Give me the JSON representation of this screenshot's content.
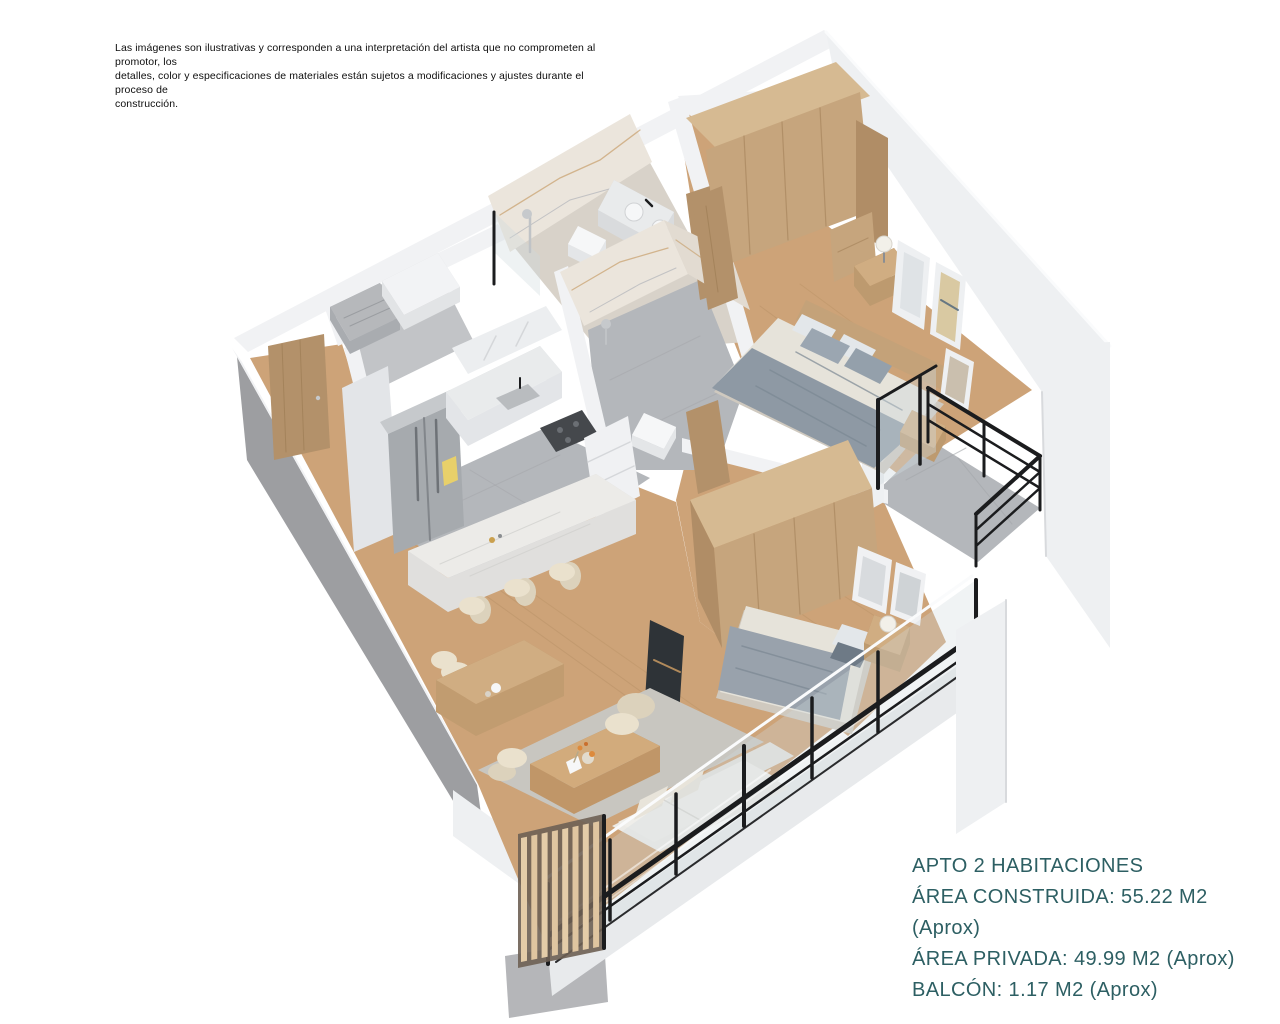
{
  "disclaimer": {
    "line1": "Las imágenes son ilustrativas y corresponden a una interpretación del artista que no comprometen al promotor, los",
    "line2": "detalles, color y especificaciones de materiales están sujetos a modificaciones y ajustes durante el proceso de",
    "line3": "construcción."
  },
  "specs": {
    "title": "APTO 2 HABITACIONES",
    "area_construida": "ÁREA CONSTRUIDA: 55.22 M2 (Aprox)",
    "area_privada": "ÁREA PRIVADA: 49.99 M2 (Aprox)",
    "balcon": "BALCÓN: 1.17 M2 (Aprox)"
  },
  "palette": {
    "background": "#ffffff",
    "wallTop": "#f1f2f4",
    "wallWhite": "#eef0f2",
    "wallBright": "#fafbfc",
    "faceGray": "#9d9ea1",
    "slabGray": "#b5b6b9",
    "wood": "#cda378",
    "woodLine": "#b08a5e",
    "tile": "#b4b7bb",
    "tileLine": "#a3a6aa",
    "bathFloor": "#d8d2c9",
    "marble": "#ebe5dc",
    "marbleVein": "#c49a62",
    "marbleGray": "#9aa0ac",
    "wardrobe": "#c6a57d",
    "wardrobeTop": "#d6ba92",
    "wardrobeSide": "#b08d66",
    "doorWood": "#b3916a",
    "steel": "#a6aaae",
    "steelDark": "#82868b",
    "counter": "#e9ebec",
    "cabinet": "#e3e5e8",
    "island": "#ecebe8",
    "blanket": "#8e99a4",
    "blanketFold": "#7b8793",
    "duvet": "#e6e3da",
    "pillow": "#e3e7ea",
    "cream": "#eae1cd",
    "creamShade": "#dcd2bc",
    "sofa": "#ecebe7",
    "rug": "#c8c6c0",
    "glass": "#cfdade",
    "frameBlack": "#1b1c1e",
    "slat": "#dfc5a0",
    "slatBack": "#6e6154",
    "lamp": "#f2f0e9",
    "accentText": "#2d5f63",
    "flower": "#dd8a3c"
  }
}
